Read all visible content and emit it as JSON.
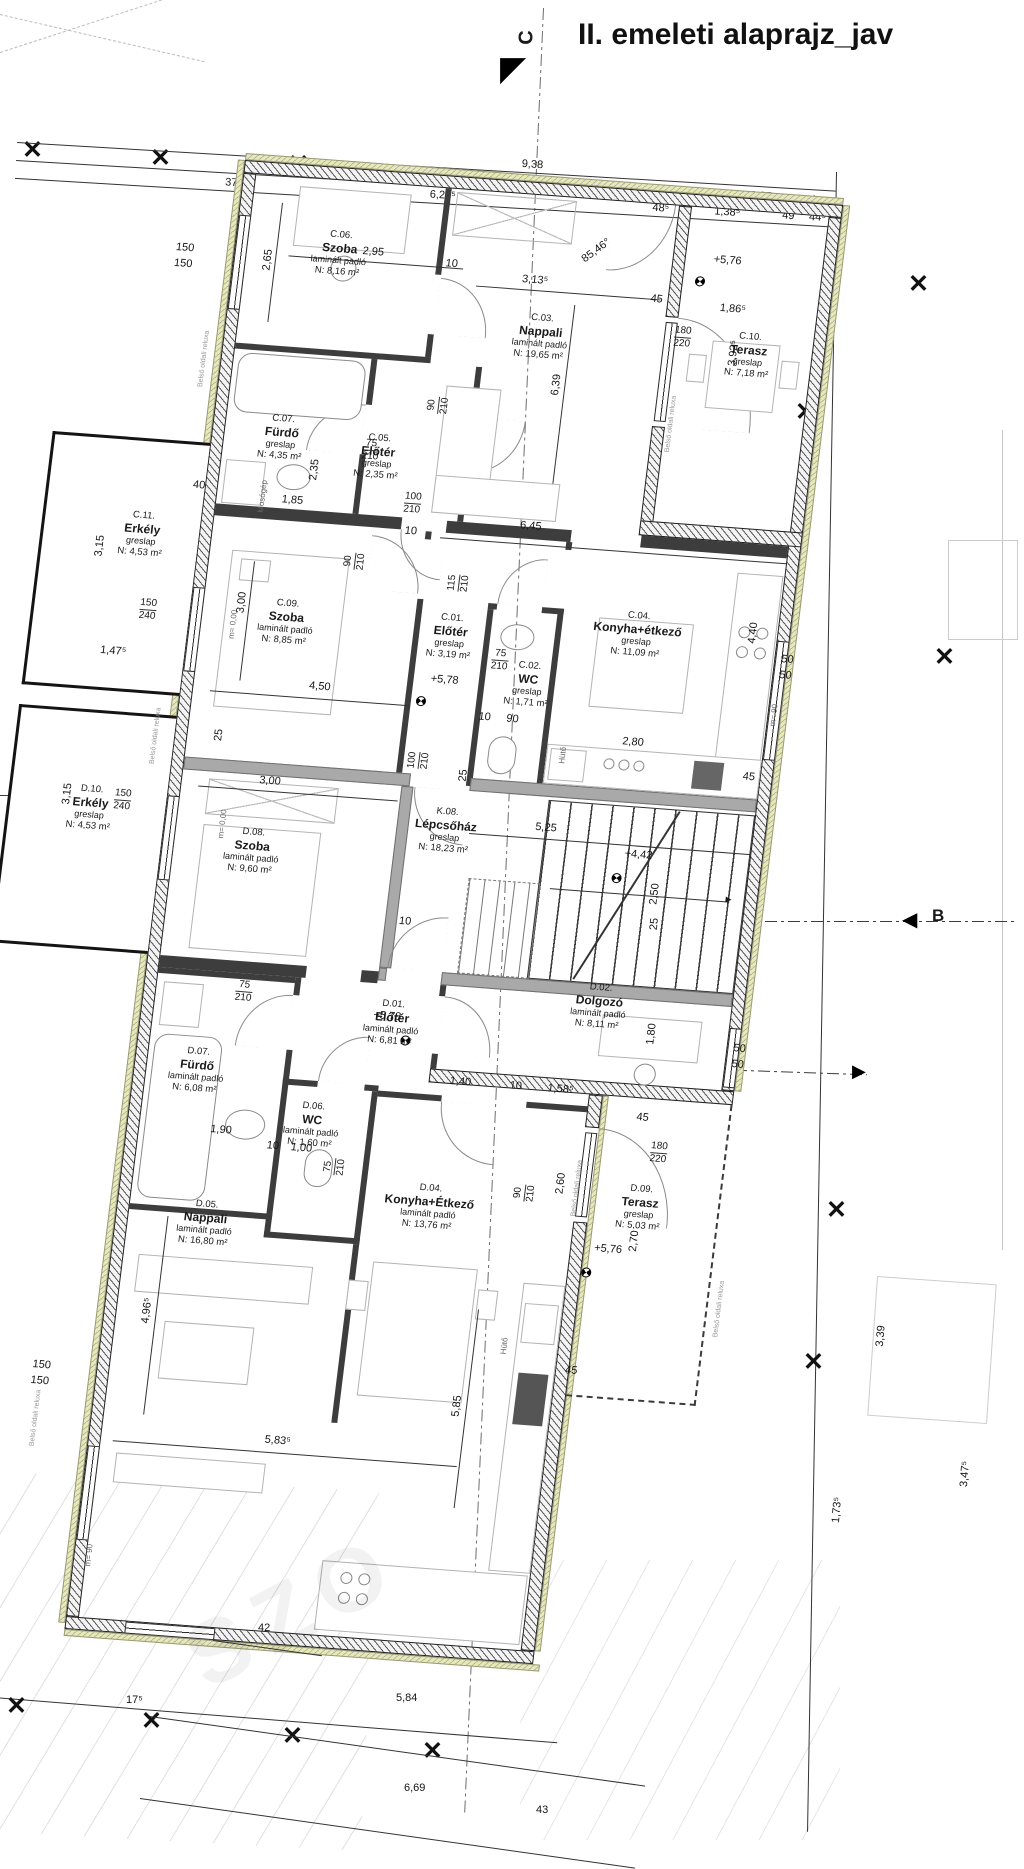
{
  "title": "II. emeleti alaprajz_jav",
  "markers": {
    "c": "C",
    "b": "B"
  },
  "icons": {
    "grid_cross": "✕",
    "tri_left": "◀",
    "tri_right": "▶",
    "tri_corner": "◤",
    "arrow_right": "►"
  },
  "labels": {
    "mosogep": "Mosógép",
    "huto": "Hütő",
    "reluxa": "Belső oldali reluxa"
  },
  "levels": {
    "l576": "+5,76",
    "l578": "+5,78",
    "l442": "+4,42",
    "m000": "m= 0,00",
    "m90": "m= 90"
  },
  "rooms": [
    {
      "id": "C.06.",
      "name": "Szoba",
      "floor": "laminált padló",
      "area": "N: 8,16 m²"
    },
    {
      "id": "C.03.",
      "name": "Nappali",
      "floor": "laminált padló",
      "area": "N: 19,65 m²"
    },
    {
      "id": "C.10.",
      "name": "Terasz",
      "floor": "greslap",
      "area": "N: 7,18 m²"
    },
    {
      "id": "C.07.",
      "name": "Fürdő",
      "floor": "greslap",
      "area": "N: 4,35 m²"
    },
    {
      "id": "C.05.",
      "name": "Előtér",
      "floor": "greslap",
      "area": "N: 2,35 m²"
    },
    {
      "id": "C.11.",
      "name": "Erkély",
      "floor": "greslap",
      "area": "N: 4,53 m²"
    },
    {
      "id": "C.09.",
      "name": "Szoba",
      "floor": "laminált padló",
      "area": "N: 8,85 m²"
    },
    {
      "id": "C.01.",
      "name": "Előtér",
      "floor": "greslap",
      "area": "N: 3,19 m²"
    },
    {
      "id": "C.02.",
      "name": "WC",
      "floor": "greslap",
      "area": "N: 1,71 m²"
    },
    {
      "id": "C.04.",
      "name": "Konyha+étkező",
      "floor": "greslap",
      "area": "N: 11,09 m²"
    },
    {
      "id": "K.08.",
      "name": "Lépcsőház",
      "floor": "greslap",
      "area": "N: 18,23 m²"
    },
    {
      "id": "D.08.",
      "name": "Szoba",
      "floor": "laminált padló",
      "area": "N: 9,60 m²"
    },
    {
      "id": "D.10.",
      "name": "Erkély",
      "floor": "greslap",
      "area": "N: 4,53 m²"
    },
    {
      "id": "D.02.",
      "name": "Dolgozó",
      "floor": "laminált padló",
      "area": "N: 8,11 m²"
    },
    {
      "id": "D.01.",
      "name": "Előtér",
      "floor": "laminált padló",
      "area": "N: 6,81 m²"
    },
    {
      "id": "D.07.",
      "name": "Fürdő",
      "floor": "laminált padló",
      "area": "N: 6,08 m²"
    },
    {
      "id": "D.06.",
      "name": "WC",
      "floor": "laminált padló",
      "area": "N: 1,60 m²"
    },
    {
      "id": "D.04.",
      "name": "Konyha+Étkező",
      "floor": "laminált padló",
      "area": "N: 13,76 m²"
    },
    {
      "id": "D.05.",
      "name": "Nappali",
      "floor": "laminált padló",
      "area": "N: 16,80 m²"
    },
    {
      "id": "D.09.",
      "name": "Terasz",
      "floor": "greslap",
      "area": "N: 5,03 m²"
    }
  ],
  "dims": {
    "n10": "10",
    "n25": "25",
    "n37": "37",
    "n40": "40",
    "n43": "43",
    "n45": "45",
    "n49": "49",
    "n50": "50",
    "n75": "75",
    "n90": "90",
    "n100": "100",
    "n115": "115",
    "n150": "150",
    "n180": "180",
    "n210": "210",
    "n220": "220",
    "n240": "240",
    "a938": "9,38",
    "a706": "7,06",
    "a6205": "6,20⁵",
    "a227": "2,27",
    "a485": "48⁵",
    "a1385": "1,38⁵",
    "a445": "44⁵",
    "a295": "2,95",
    "a265": "2,65",
    "a3135": "3,13⁵",
    "a639": "6,39",
    "ang": "85,46°",
    "a1865": "1,86⁵",
    "a3925": "3,92⁵",
    "a645": "6,45",
    "a185": "1,85",
    "a235": "2,35",
    "a315": "3,15",
    "a1475": "1,47⁵",
    "a300": "3,00",
    "a450": "4,50",
    "a440": "4,40",
    "a280": "2,80",
    "a525": "5,25",
    "a250": "2,50",
    "a260": "2,60",
    "a180": "1,80",
    "a190": "1,90",
    "a100": "1,00",
    "a140": "1,40",
    "a1585": "1,58⁵",
    "a270": "2,70",
    "a585": "5,85",
    "a5835": "5,83⁵",
    "a4965": "4,96⁵",
    "a42": "42",
    "a175": "17⁵",
    "a584": "5,84",
    "a669": "6,69",
    "a339": "3,39",
    "a3475": "3,47⁵",
    "a1735": "1,73⁵"
  }
}
